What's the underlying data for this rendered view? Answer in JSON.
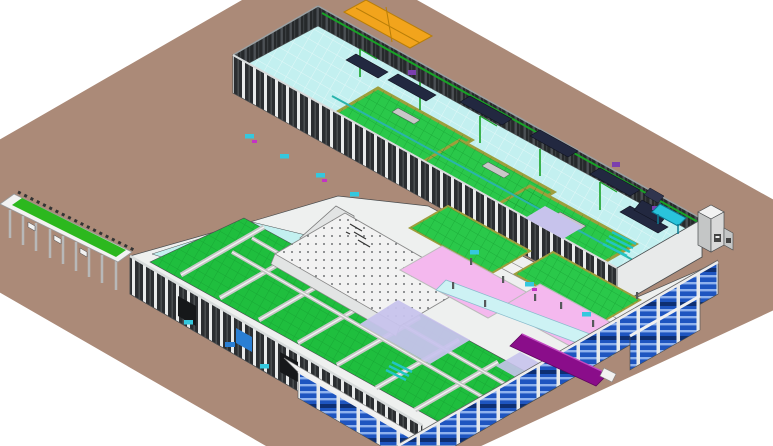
{
  "meta": {
    "description": "Isometric 3D BIM model view of an industrial production plant on a brown site plane",
    "view": "isometric",
    "visible_text": ""
  },
  "colors": {
    "bg": "#ffffff",
    "ground": "#ab8a78",
    "wallDark": "#26292b",
    "wallStripe": "#4b5054",
    "wallStripe2": "#3a3e41",
    "wallDark2": "#2b2e31",
    "wallStripe3": "#4d5154",
    "colWhite": "#e8eaea",
    "cyanFloor": "#c3f0f0",
    "walkwayCyan": "#cdf2f4",
    "greenUpper": "#2ac84a",
    "greenLower": "#1fbe3e",
    "greenGrid": "#12962e",
    "khaki": "#9e9e3c",
    "tealEquip": "#2ab4ac",
    "tealBright": "#22c4c4",
    "awning": "#2ac4dc",
    "rackBlue": "#1e55c0",
    "rackStripe": "#8fb2ee",
    "rackDark": "#0e2f72",
    "pink": "#f4b8ee",
    "lavender": "#c7c3ec",
    "canopyGreen": "#2cb81e",
    "orange": "#f2a41c",
    "orangeEdge": "#b97e08",
    "purple": "#8a0d8a",
    "purpleLight": "#c24ac2",
    "magenta": "#c433c4",
    "palletCyan": "#35c8de",
    "doorBlue": "#2a7fd4",
    "boxGray": "#d9d9d9",
    "boxGraySide": "#c4c6c6",
    "whiteStruct": "#f2f2f2",
    "grayStruct": "#e2e4e4",
    "lightBody": "#eef0ef",
    "beamGray": "#c8c8c8",
    "machineDark": "#222840",
    "machineMid": "#30354e",
    "machinePurple": "#7b3fae",
    "mezzDot": "#5a5d60",
    "pipeGreen": "#18a226",
    "capLight": "#d8dcdc",
    "capGray": "#9aa0a2",
    "outline": "#4a4d4f",
    "lightBlueUnit": "#c7d8f0"
  },
  "scene": {
    "structures": [
      {
        "name": "site-ground-plane",
        "color_ref": "ground"
      },
      {
        "name": "upper-production-hall",
        "color_ref": "cyanFloor"
      },
      {
        "name": "upper-hall-back-colonnade",
        "color_ref": "wallDark"
      },
      {
        "name": "orange-rooftop-unit",
        "color_ref": "orange"
      },
      {
        "name": "green-equipment-pits",
        "color_ref": "greenUpper"
      },
      {
        "name": "overhead-teal-conveyors",
        "color_ref": "tealEquip"
      },
      {
        "name": "process-machines",
        "color_ref": "machineDark"
      },
      {
        "name": "loading-canopy",
        "color_ref": "canopyGreen"
      },
      {
        "name": "lower-production-hall",
        "color_ref": "greenLower"
      },
      {
        "name": "conveyor-bridges",
        "color_ref": "beamGray"
      },
      {
        "name": "central-mezzanine-roof",
        "color_ref": "whiteStruct"
      },
      {
        "name": "pink-cleanrooms",
        "color_ref": "pink"
      },
      {
        "name": "lavender-zones",
        "color_ref": "lavender"
      },
      {
        "name": "blue-pallet-racking",
        "color_ref": "rackBlue"
      },
      {
        "name": "purple-dock-ramp",
        "color_ref": "purple"
      },
      {
        "name": "teal-stairs-and-pallets",
        "color_ref": "tealBright"
      },
      {
        "name": "external-utility-cabinet",
        "color_ref": "boxGray"
      }
    ]
  }
}
